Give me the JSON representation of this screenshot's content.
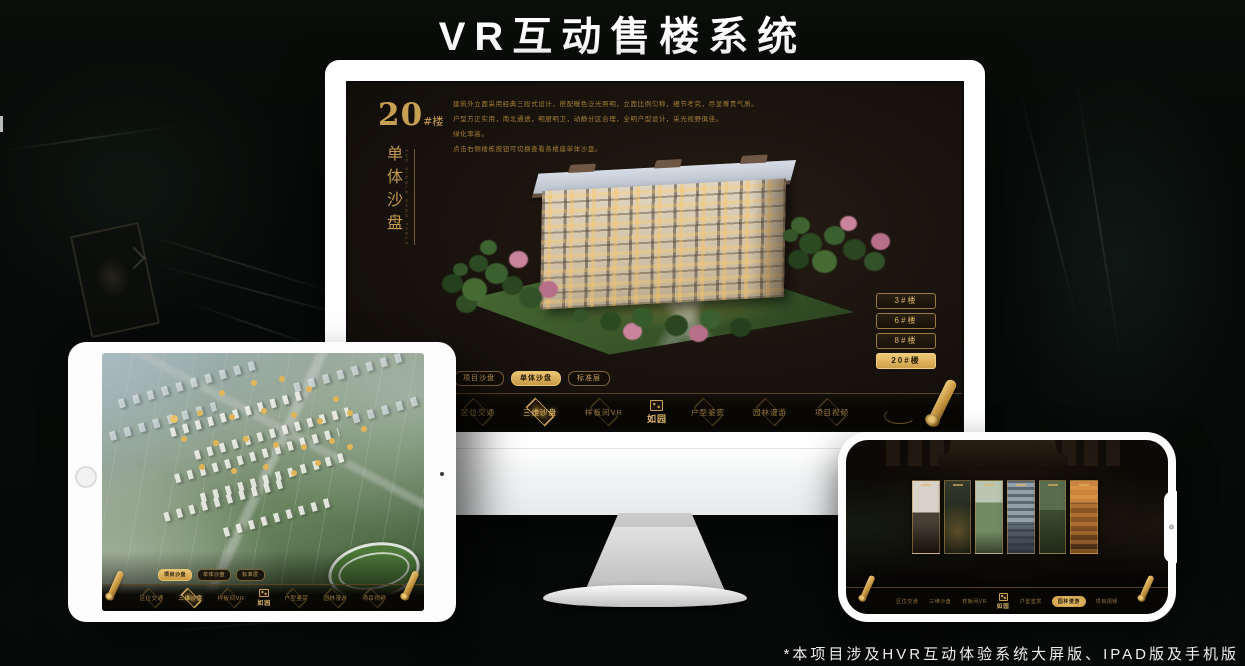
{
  "title": "VR互动售楼系统",
  "footnote": "*本项目涉及HVR互动体验系统大屏版、IPAD版及手机版",
  "colors": {
    "gold": "#c9a257",
    "gold_bright": "#eec873",
    "gold_fill": "#d9ad5c",
    "screen_bg": "#1a140e"
  },
  "monitor": {
    "building_label": {
      "number": "20",
      "suffix": "#楼",
      "vertical_title": "单体沙盘",
      "vertical_subtitle_en": "THE SINGLE SAND TABLE"
    },
    "description_lines": [
      "建筑外立面采用经典三段式设计，搭配暖色泛光照明，立面比例匀称，细节考究，尽显尊贵气质。",
      "户型方正实用，南北通透，明厨明卫，动静分区合理，全明户型设计，采光视野俱佳。",
      "绿化率高。",
      "点击右侧楼栋按钮可切换查看各楼座单体沙盘。"
    ],
    "floor_buttons": [
      {
        "label": "3#楼",
        "active": false
      },
      {
        "label": "6#楼",
        "active": false
      },
      {
        "label": "8#楼",
        "active": false
      },
      {
        "label": "20#楼",
        "active": true
      }
    ],
    "view_tabs": [
      {
        "label": "项目沙盘",
        "active": false
      },
      {
        "label": "单体沙盘",
        "active": true
      },
      {
        "label": "标准层",
        "active": false
      }
    ],
    "nav": {
      "logo": "如园",
      "items": [
        {
          "label": "区位交通",
          "active": false
        },
        {
          "label": "三维沙盘",
          "active": true
        },
        {
          "label": "样板间VR",
          "active": false
        },
        {
          "label": "户型鉴赏",
          "active": false
        },
        {
          "label": "园林漫游",
          "active": false
        },
        {
          "label": "项目视频",
          "active": false
        }
      ]
    }
  },
  "tablet": {
    "view_tabs": [
      {
        "label": "项目沙盘",
        "active": true
      },
      {
        "label": "单体沙盘",
        "active": false
      },
      {
        "label": "标准层",
        "active": false
      }
    ],
    "nav": {
      "logo": "如园",
      "items": [
        {
          "label": "区位交通",
          "active": false
        },
        {
          "label": "三维沙盘",
          "active": true
        },
        {
          "label": "样板间VR",
          "active": false
        },
        {
          "label": "户型鉴赏",
          "active": false
        },
        {
          "label": "园林漫游",
          "active": false
        },
        {
          "label": "项目视频",
          "active": false
        }
      ]
    }
  },
  "phone": {
    "nav": {
      "logo": "如园",
      "items": [
        {
          "label": "区位交通",
          "active": false
        },
        {
          "label": "三维沙盘",
          "active": false
        },
        {
          "label": "样板间VR",
          "active": false
        },
        {
          "label": "户型鉴赏",
          "active": false
        },
        {
          "label": "园林漫游",
          "active": true
        },
        {
          "label": "项目视频",
          "active": false
        }
      ]
    }
  }
}
